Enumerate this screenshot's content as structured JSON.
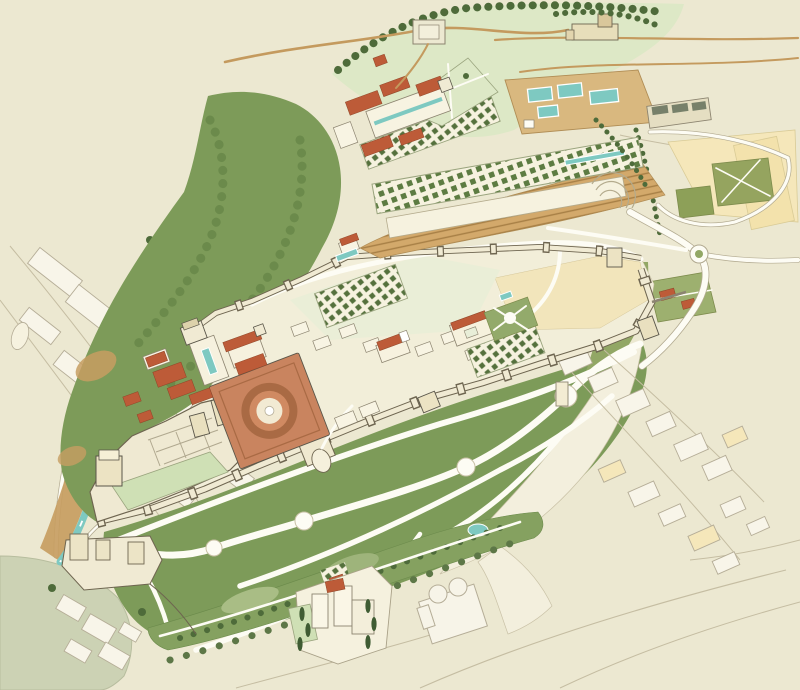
{
  "canvas": {
    "width": 800,
    "height": 690
  },
  "map": {
    "kind": "illustrated-birdseye-map",
    "features": [
      "city-sketch-left",
      "darro-river",
      "river-ravine",
      "wooded-slope",
      "citadel-plateau",
      "north-wall",
      "south-wall",
      "alcazaba-fortress",
      "watch-tower",
      "justice-gate",
      "charles-v-palace",
      "circular-courtyard",
      "nasrid-palaces",
      "comares-tower",
      "court-pool",
      "medina-buildings",
      "garden-plots",
      "partal-pool",
      "secano-field",
      "generalife-palace",
      "generalife-gardens",
      "amphitheater-terrace",
      "terraced-slope",
      "cistern-pools",
      "silla-del-moro-fort",
      "upper-meadow",
      "ridge-trees",
      "cemetery-building",
      "yellow-fields",
      "olive-plots",
      "roundabout",
      "outer-roads",
      "northeast-garden",
      "esplanade-lawn",
      "winding-paths",
      "path-nodes",
      "lower-garden-strip",
      "pond",
      "torres-bermejas",
      "white-tower-building",
      "faint-auditorium",
      "city-sketch-right",
      "city-sketch-bottom-left",
      "muted-hill",
      "promenade-trees"
    ]
  },
  "palette": {
    "bg": "#ece8d1",
    "ink": "#5a564a",
    "faint": "#b5ad97",
    "faintFill": "#f8f5e9",
    "wall": "#f0ead3",
    "wallShade": "#ddd2ab",
    "stone": "#e7deba",
    "plateau": "#f2eed9",
    "greenDark": "#7d9b59",
    "greenMid": "#93aa6b",
    "greenPale": "#dde8c6",
    "greenMuted": "#ccd2b4",
    "hedge": "#55713d",
    "treeDark": "#4e6b3a",
    "roofRed": "#bd5b38",
    "terracotta": "#c9845f",
    "terracottaDark": "#a96a44",
    "water": "#7ec9c1",
    "earth": "#c79d61",
    "earthLight": "#d9b87f",
    "sand": "#f5e7ba",
    "white": "#fdfcf4"
  }
}
